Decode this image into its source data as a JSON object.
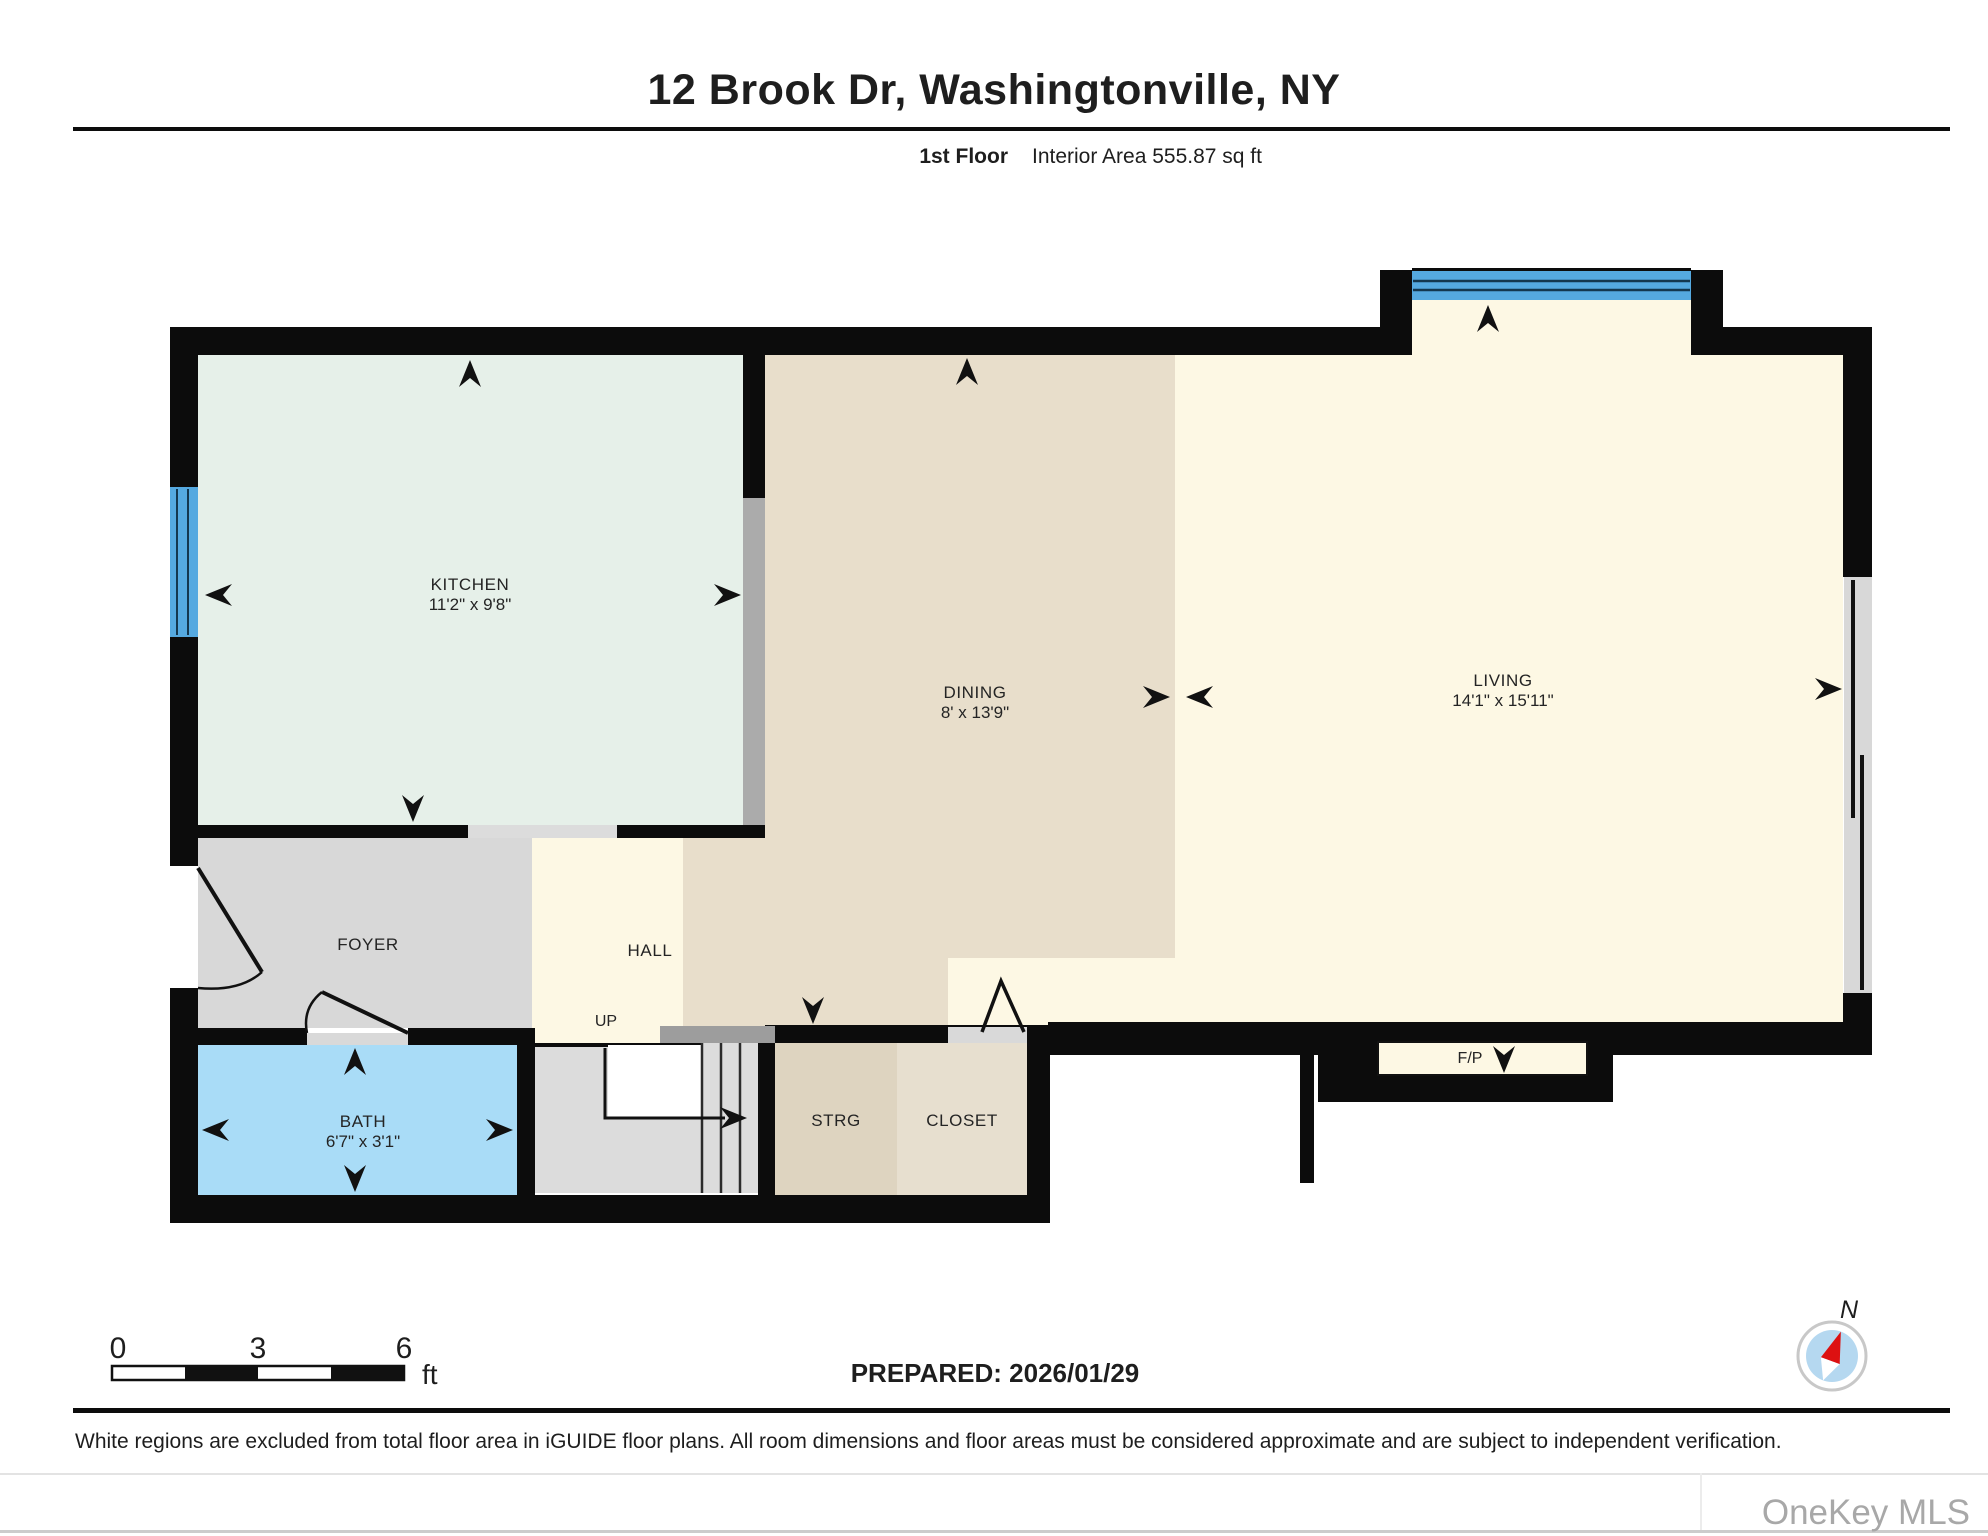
{
  "header": {
    "title": "12 Brook Dr, Washingtonville, NY",
    "floor_label": "1st Floor",
    "area_label": "Interior Area 555.87 sq ft"
  },
  "rooms": {
    "kitchen": {
      "name": "KITCHEN",
      "dims": "11'2\" x 9'8\""
    },
    "dining": {
      "name": "DINING",
      "dims": "8' x 13'9\""
    },
    "living": {
      "name": "LIVING",
      "dims": "14'1\" x 15'11\""
    },
    "foyer": {
      "name": "FOYER"
    },
    "hall": {
      "name": "HALL"
    },
    "bath": {
      "name": "BATH",
      "dims": "6'7\" x 3'1\""
    },
    "strg": {
      "name": "STRG"
    },
    "closet": {
      "name": "CLOSET"
    },
    "fireplace": {
      "name": "F/P"
    },
    "stairs": {
      "label": "UP"
    }
  },
  "scale_bar": {
    "tick0": "0",
    "tick1": "3",
    "tick2": "6",
    "unit": "ft"
  },
  "footer": {
    "prepared": "PREPARED: 2026/01/29",
    "disclaimer": "White regions are excluded from total floor area in iGUIDE floor plans. All room dimensions and floor areas must be considered approximate and are subject to independent verification.",
    "watermark": "OneKey MLS",
    "compass_label": "N"
  },
  "colors": {
    "wall": "#0c0c0c",
    "kitchen": "#e6f0e9",
    "dining": "#e8decb",
    "living": "#fdf8e4",
    "foyer": "#d8d8d8",
    "bath": "#a9dcf7",
    "stairs": "#dcdcdc",
    "strg": "#ded4c0",
    "closet": "#e7dfcf",
    "window": "#55a9e0",
    "divider_gray": "#ababab",
    "threshold_gray": "#d9d9d9"
  }
}
